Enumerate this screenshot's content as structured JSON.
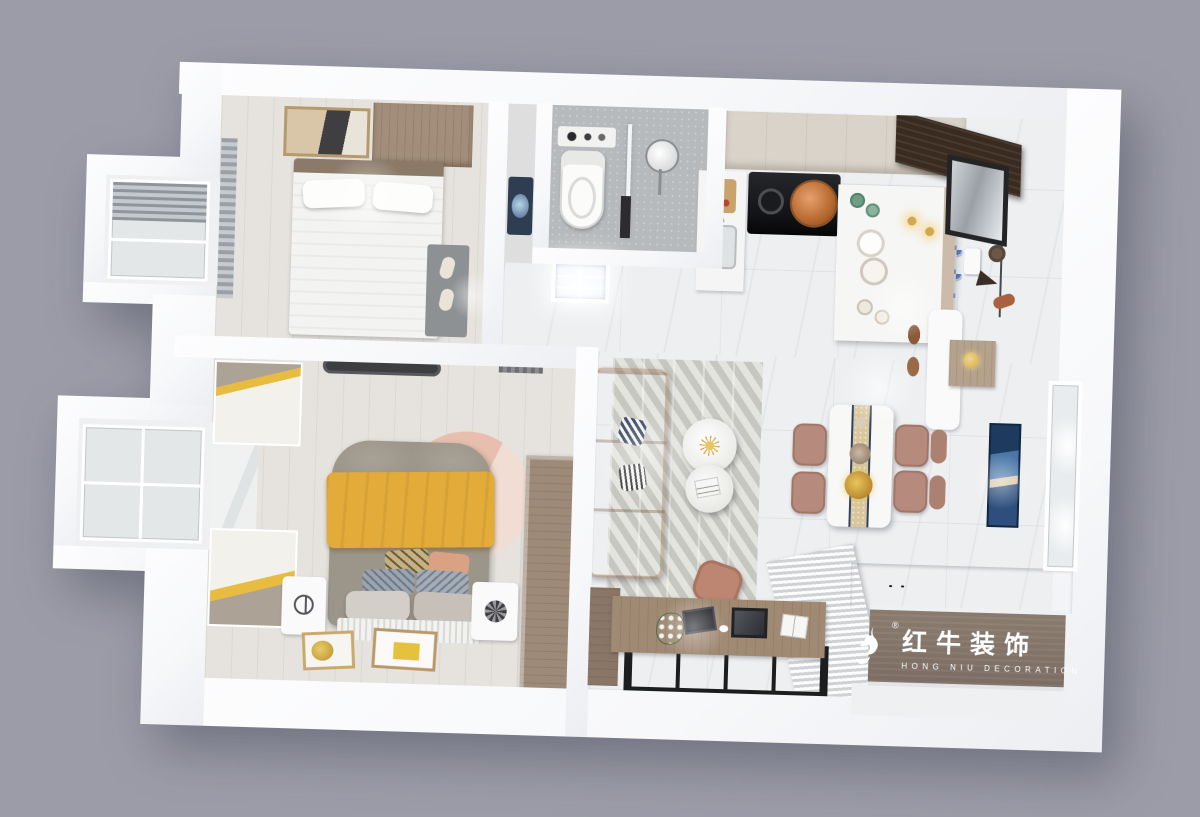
{
  "scene": {
    "type": "3d-interior-floorplan-render",
    "view": "top-down-axonometric",
    "background_color": "#9b9ca7",
    "rooms": [
      {
        "name": "second-bedroom",
        "furniture": [
          "wardrobe",
          "wall-art",
          "single-bed",
          "pillow x2",
          "bedside-rug",
          "slippers",
          "window-blind"
        ]
      },
      {
        "name": "bathroom",
        "furniture": [
          "wall-shelf",
          "toilet",
          "glass-shower-partition",
          "rain-shower-head"
        ]
      },
      {
        "name": "laundry-niche",
        "furniture": [
          "washing-machine"
        ]
      },
      {
        "name": "hallway",
        "furniture": [
          "flush-ceiling-light"
        ]
      },
      {
        "name": "kitchen",
        "furniture": [
          "upper-cabinets",
          "gas-stove",
          "copper-pot",
          "sink-counter",
          "cutting-board",
          "island-counter",
          "green-cups",
          "plate-stack",
          "white-cups"
        ]
      },
      {
        "name": "entryway",
        "furniture": [
          "dark-wood-shoe-cabinet",
          "wall-mirror",
          "coat-rack",
          "hats-and-bag",
          "wall-dispenser",
          "white-bench",
          "shoes",
          "wood-shoe-stool",
          "blue-pattern-tiles",
          "gold-pendant-light x2"
        ]
      },
      {
        "name": "dining-area",
        "furniture": [
          "dining-table",
          "table-runner",
          "flower-centerpiece",
          "dining-chair x4",
          "blue-wall-art",
          "window"
        ]
      },
      {
        "name": "living-room",
        "furniture": [
          "leather-sofa",
          "throw-pillow x2",
          "chevron-rug",
          "round-coffee-table x2",
          "pink-ottoman"
        ]
      },
      {
        "name": "tv-wall",
        "furniture": [
          "louvered-tv-cabinet",
          "brand-wood-panel",
          "tv-console-top",
          "tv-console-base",
          "drawer-with-books"
        ]
      },
      {
        "name": "study-balcony",
        "furniture": [
          "desk",
          "laptop",
          "monitor-frame",
          "mouse",
          "notebook",
          "desk-plant",
          "side-cabinet",
          "glass-floor-panels"
        ]
      },
      {
        "name": "master-bedroom",
        "furniture": [
          "double-bed",
          "yellow-blanket",
          "pillow-stack x6",
          "round-pink-rug",
          "nightstand x2",
          "wardrobe",
          "striped-wall-panel x2",
          "window-sill",
          "floor-picture-frame x2",
          "ceiling-light",
          "air-vent"
        ]
      },
      {
        "name": "bay-window-upper",
        "furniture": [
          "window-frame",
          "roller-blind"
        ]
      },
      {
        "name": "bay-window-lower",
        "furniture": [
          "window-frame"
        ]
      }
    ]
  },
  "watermark": {
    "registered": "®",
    "brand_cn": "红牛装饰",
    "brand_en": "HONG NIU DECORATION",
    "icon": "hongniu-bull-icon"
  },
  "colors": {
    "bg": "#9b9ca7",
    "wall": "#f7f8fa",
    "marble": "#edeff1",
    "warmfloor": "#e6e3de",
    "tile": "#b7babc",
    "wood": "#9d8a79",
    "woodark": "#3a2b21",
    "logowood": "#7b6d63",
    "sofa": "#d0915f",
    "sofadark": "#b97c4e",
    "yellow": "#e2ab3a",
    "pinkrug": "#e8bfae",
    "mauve": "#b68a7c",
    "blueart": "#2e4f7d",
    "bedgray": "#9c9589",
    "gold": "#d2a84e",
    "tileblue": "#5b79b4",
    "glass": "#e3e7e8",
    "dark": "#1d1e20"
  }
}
